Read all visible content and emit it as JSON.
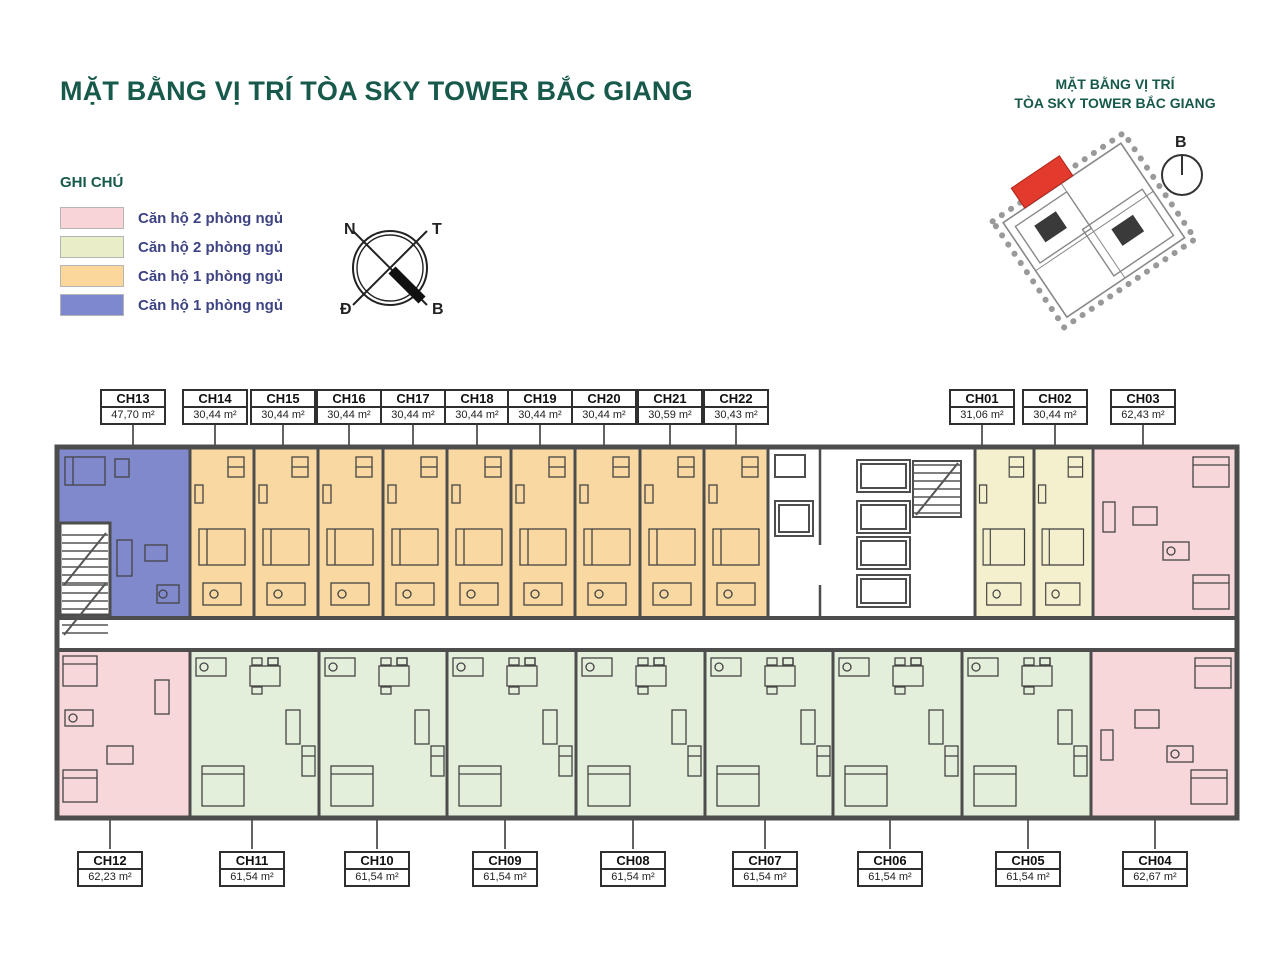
{
  "page": {
    "title": "MẶT BẰNG VỊ TRÍ TÒA SKY TOWER BẮC GIANG"
  },
  "legend": {
    "heading": "GHI CHÚ",
    "items": [
      {
        "label": "Căn hộ 2 phòng ngủ",
        "color": "#f8d3d8"
      },
      {
        "label": "Căn hộ 2 phòng ngủ",
        "color": "#e9eec9"
      },
      {
        "label": "Căn hộ 1 phòng ngủ",
        "color": "#fbd79b"
      },
      {
        "label": "Căn hộ 1 phòng ngủ",
        "color": "#7d88cf"
      }
    ]
  },
  "compass": {
    "n": "N",
    "t": "T",
    "d": "Đ",
    "b": "B"
  },
  "inset": {
    "title_line1": "MẶT BẰNG VỊ TRÍ",
    "title_line2": "TÒA SKY TOWER BẮC GIANG",
    "compass_label": "B",
    "highlight_color": "#e23b2e"
  },
  "plan": {
    "colors": {
      "wall": "#4d4d4d",
      "unit_pink": "#f8d7da",
      "unit_green": "#e4efdb",
      "unit_orange": "#f9d9a1",
      "unit_cream": "#f4f0cd",
      "unit_blue": "#8089cc"
    },
    "units": [
      {
        "code": "CH13",
        "area": "47,70 m²",
        "type": "1-bedroom-blue"
      },
      {
        "code": "CH14",
        "area": "30,44 m²",
        "type": "1-bedroom-orange"
      },
      {
        "code": "CH15",
        "area": "30,44 m²",
        "type": "1-bedroom-orange"
      },
      {
        "code": "CH16",
        "area": "30,44 m²",
        "type": "1-bedroom-orange"
      },
      {
        "code": "CH17",
        "area": "30,44 m²",
        "type": "1-bedroom-orange"
      },
      {
        "code": "CH18",
        "area": "30,44 m²",
        "type": "1-bedroom-orange"
      },
      {
        "code": "CH19",
        "area": "30,44 m²",
        "type": "1-bedroom-orange"
      },
      {
        "code": "CH20",
        "area": "30,44 m²",
        "type": "1-bedroom-orange"
      },
      {
        "code": "CH21",
        "area": "30,59 m²",
        "type": "1-bedroom-orange"
      },
      {
        "code": "CH22",
        "area": "30,43 m²",
        "type": "1-bedroom-orange"
      },
      {
        "code": "CH01",
        "area": "31,06 m²",
        "type": "1-bedroom-cream"
      },
      {
        "code": "CH02",
        "area": "30,44 m²",
        "type": "1-bedroom-cream"
      },
      {
        "code": "CH03",
        "area": "62,43 m²",
        "type": "2-bedroom-pink"
      },
      {
        "code": "CH12",
        "area": "62,23 m²",
        "type": "2-bedroom-pink"
      },
      {
        "code": "CH11",
        "area": "61,54 m²",
        "type": "2-bedroom-green"
      },
      {
        "code": "CH10",
        "area": "61,54 m²",
        "type": "2-bedroom-green"
      },
      {
        "code": "CH09",
        "area": "61,54 m²",
        "type": "2-bedroom-green"
      },
      {
        "code": "CH08",
        "area": "61,54 m²",
        "type": "2-bedroom-green"
      },
      {
        "code": "CH07",
        "area": "61,54 m²",
        "type": "2-bedroom-green"
      },
      {
        "code": "CH06",
        "area": "61,54 m²",
        "type": "2-bedroom-green"
      },
      {
        "code": "CH05",
        "area": "61,54 m²",
        "type": "2-bedroom-green"
      },
      {
        "code": "CH04",
        "area": "62,67 m²",
        "type": "2-bedroom-pink"
      }
    ]
  }
}
